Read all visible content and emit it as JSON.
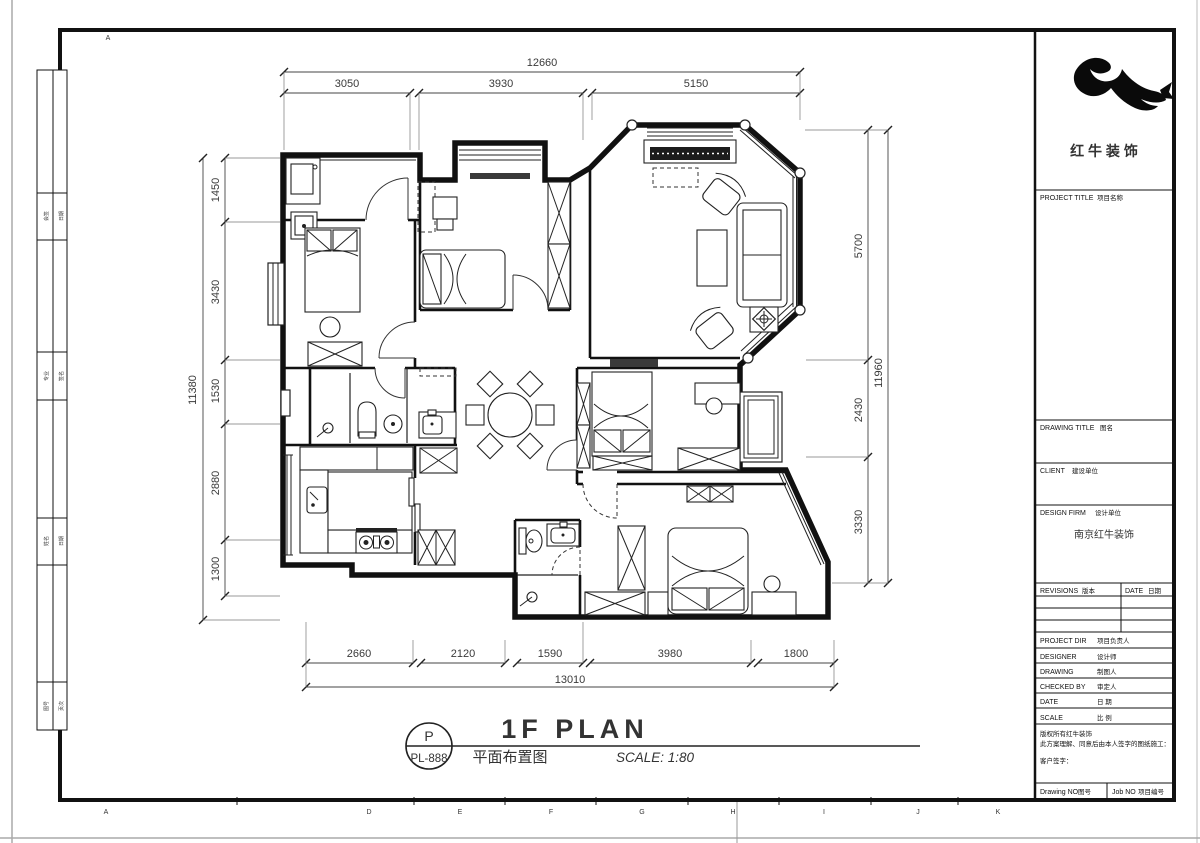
{
  "drawing": {
    "sheet_letter": "P",
    "sheet_code": "PL-888",
    "title_en": "1F PLAN",
    "title_zh": "平面布置图",
    "scale_text": "SCALE: 1:80"
  },
  "dims": {
    "top": {
      "total": "12660",
      "segments": [
        "3050",
        "3930",
        "5150"
      ]
    },
    "left": {
      "total": "11380",
      "segments": [
        "1450",
        "3430",
        "1530",
        "2880",
        "1300"
      ]
    },
    "right": {
      "total": "11960",
      "segments": [
        "5700",
        "2430",
        "3330"
      ]
    },
    "bottom": {
      "total": "13010",
      "segments": [
        "2660",
        "2120",
        "1590",
        "3980",
        "1800"
      ]
    }
  },
  "title_block": {
    "logo_text": "红 牛 装 饰",
    "project_label": "PROJECT TITLE",
    "project_label_zh": "项目名称",
    "drawing_label": "DRAWING TITLE",
    "drawing_label_zh": "图名",
    "client_label": "CLIENT",
    "client_label_zh": "建设单位",
    "design_firm_label": "DESIGN FIRM",
    "design_firm_label_zh": "设计单位",
    "design_firm_value": "南京红牛装饰",
    "revisions_label": "REVISIONS",
    "revisions_label_zh": "版本",
    "date_col_label": "DATE",
    "date_col_label_zh": "日期",
    "project_dir_label": "PROJECT DIR",
    "project_dir_label_zh": "项目负责人",
    "designer_label": "DESIGNER",
    "designer_label_zh": "设计师",
    "drawing_by_label": "DRAWING",
    "drawing_by_label_zh": "制图人",
    "checked_by_label": "CHECKED BY",
    "checked_by_label_zh": "审定人",
    "date_label": "DATE",
    "date_label_zh": "日 期",
    "scale_label": "SCALE",
    "scale_label_zh": "比 例",
    "copyright_line1": "版权所有红牛装饰",
    "copyright_line2": "此方案理解、同意后由本人签字的图纸施工：",
    "customer_sign_label": "客户签字：",
    "drawing_no_label": "Drawing NO",
    "drawing_no_label_zh": "图号",
    "job_no_label": "Job NO",
    "job_no_label_zh": "项目编号"
  },
  "frame": {
    "top_marker": "A",
    "bottom_letters": [
      "A",
      "D",
      "E",
      "F",
      "G",
      "H",
      "I",
      "J",
      "K"
    ]
  },
  "binding_strip": {
    "rows": [
      {
        "a": "会签",
        "b": "日期"
      },
      {
        "a": "专业",
        "b": "签名"
      },
      {
        "a": "姓名",
        "b": "日期"
      },
      {
        "a": "图号",
        "b": "页次"
      }
    ]
  }
}
